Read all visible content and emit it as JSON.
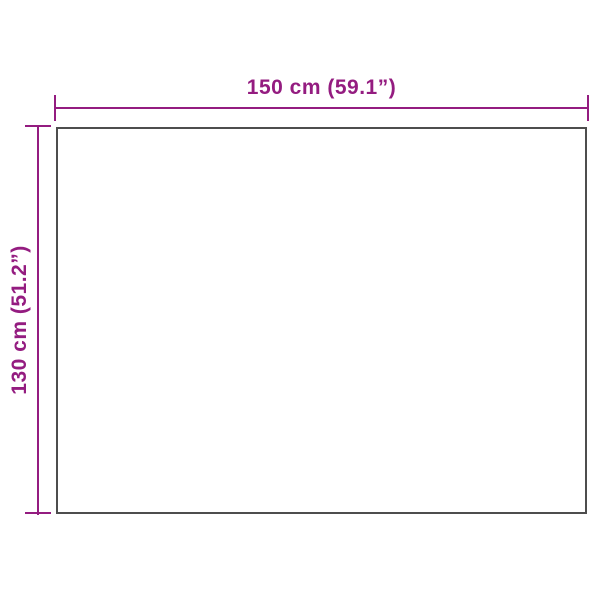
{
  "diagram": {
    "type": "product-dimension-diagram",
    "background_color": "#ffffff",
    "accent_color": "#941c80",
    "outline_color": "#4d4d4d",
    "width_label": "150 cm (59.1”)",
    "height_label": "130 cm (51.2”)",
    "width_value_cm": 150,
    "width_value_inches": 59.1,
    "height_value_cm": 130,
    "height_value_inches": 51.2
  }
}
